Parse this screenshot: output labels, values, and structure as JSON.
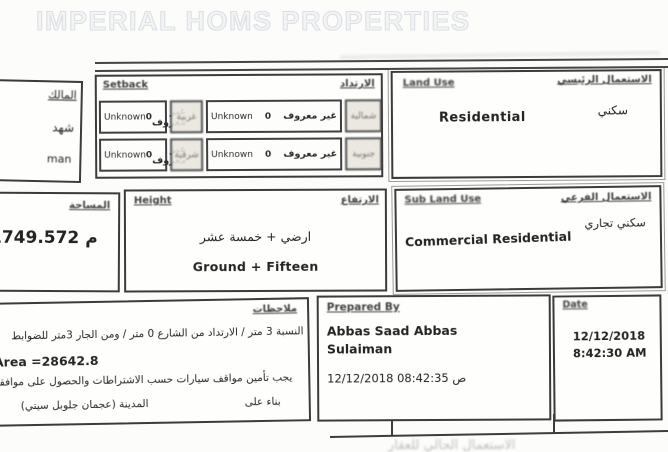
{
  "watermark": "IMPERIAL HOMS PROPERTIES",
  "owner_box": {
    "frag1": "المالك",
    "frag2": "شهد",
    "frag3": "man"
  },
  "setback": {
    "title_en": "Setback",
    "title_ar": "الارتداد",
    "rows": [
      {
        "v1_en": "Unknown",
        "v1_num": "0",
        "v1_ar": "غير معروف",
        "d1": "غربية",
        "v2_en": "Unknown",
        "v2_num": "0",
        "v2_ar": "غير معروف",
        "d2": "شمالية"
      },
      {
        "v1_en": "Unknown",
        "v1_num": "0",
        "v1_ar": "غير معروف",
        "d1": "شرقية",
        "v2_en": "Unknown",
        "v2_num": "0",
        "v2_ar": "غير معروف",
        "d2": "جنوبية"
      }
    ]
  },
  "land_use": {
    "title_en": "Land Use",
    "title_ar": "الاستعمال الرئيسي",
    "value_en": "Residential",
    "value_ar": "سكني"
  },
  "area": {
    "title_ar": "المساحة",
    "unit": "م",
    "value": "1749.572"
  },
  "height": {
    "title_en": "Height",
    "title_ar": "الارتفاع",
    "value_ar": "ارضي + خمسة عشر",
    "value_en": "Ground + Fifteen"
  },
  "sub_land_use": {
    "title_en": "Sub Land Use",
    "title_ar": "الاستعمال الفرعي",
    "value_en": "Commercial Residential",
    "value_ar": "سكني تجاري"
  },
  "notes": {
    "title_ar": "ملاحظات",
    "line1": "النسبة 3 متر / الارتداد من الشارع 0 متر / ومن الجار 3متر للضوابط",
    "line2": "Area =28642.8",
    "line3": "يجب تأمين مواقف سيارات حسب الاشتراطات والحصول على موافقة",
    "line4_a": "المدينة (عجمان جلوبل سيتي)",
    "line4_b": "بناء على"
  },
  "prepared_by": {
    "title_en": "Prepared By",
    "name_line1": "Abbas Saad Abbas",
    "name_line2": "Sulaiman",
    "datetime": "12/12/2018 08:42:35 ص"
  },
  "date_box": {
    "title_en": "Date",
    "date": "12/12/2018",
    "time": "8:42:30 AM"
  },
  "footer_fragment": "الاستعمال الحالي للعقار"
}
